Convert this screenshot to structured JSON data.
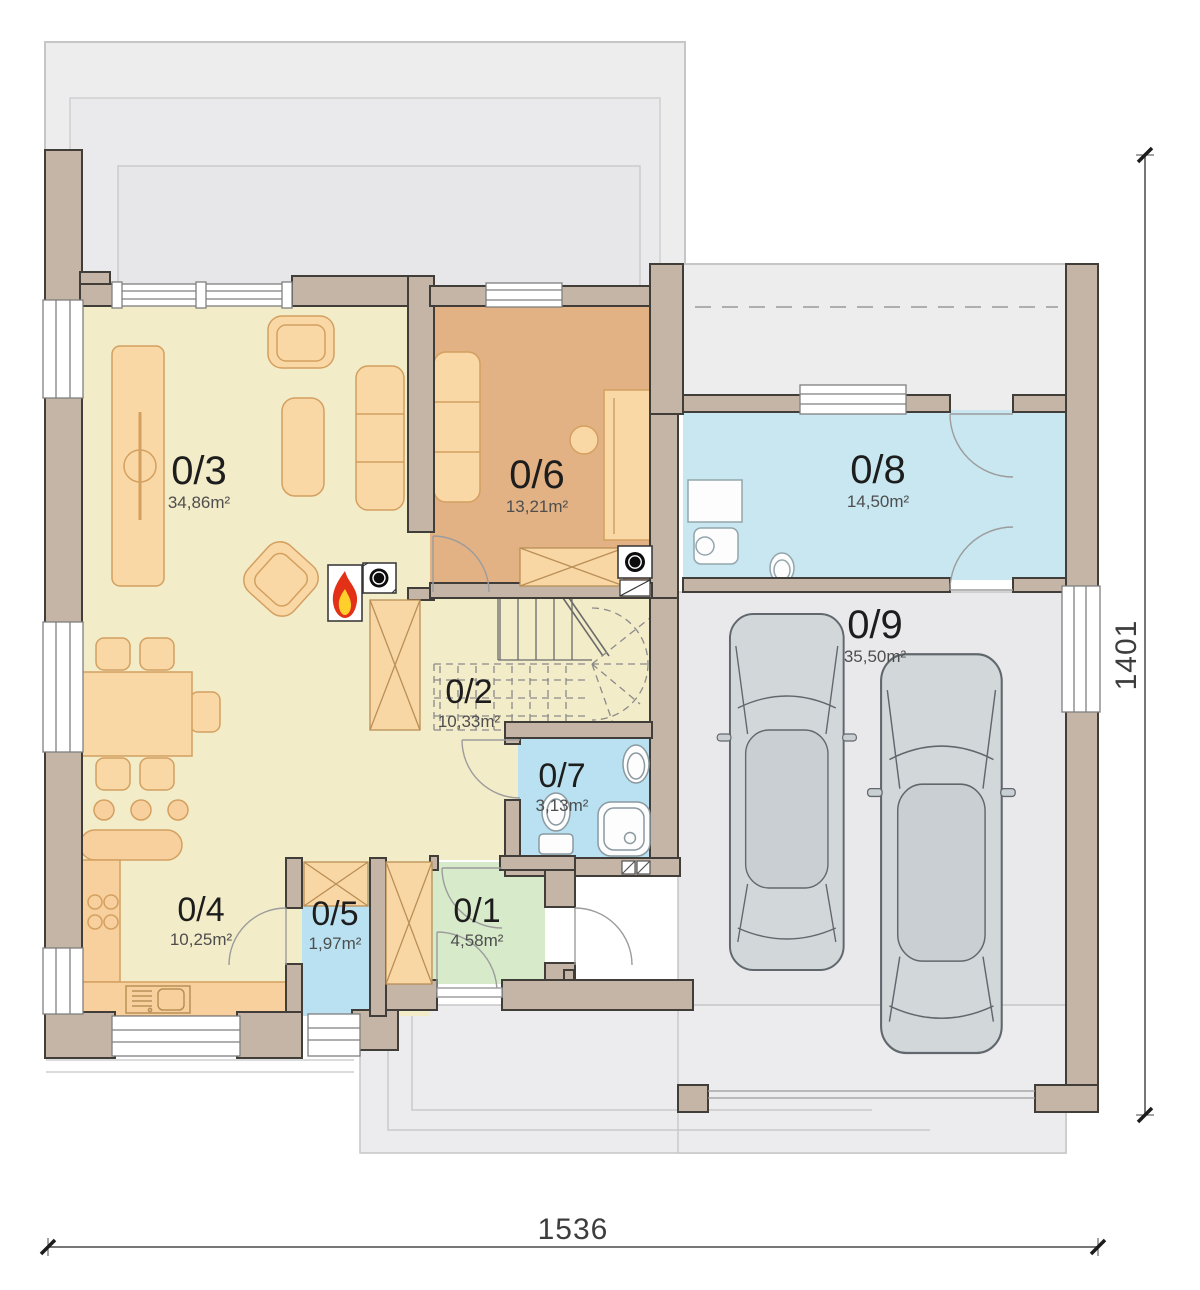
{
  "plan": {
    "rooms": [
      {
        "number": "0/1",
        "area": "4,58m²"
      },
      {
        "number": "0/2",
        "area": "10,33m²"
      },
      {
        "number": "0/3",
        "area": "34,86m²"
      },
      {
        "number": "0/4",
        "area": "10,25m²"
      },
      {
        "number": "0/5",
        "area": "1,97m²"
      },
      {
        "number": "0/6",
        "area": "13,21m²"
      },
      {
        "number": "0/7",
        "area": "3,13m²"
      },
      {
        "number": "0/8",
        "area": "14,50m²"
      },
      {
        "number": "0/9",
        "area": "35,50m²"
      }
    ],
    "dimensions": {
      "bottom": "1536",
      "right": "1401"
    },
    "colors": {
      "cream_floor": "#f3ecc8",
      "tan_floor": "#e2b184",
      "blue_floor": "#b9e1f1",
      "blue_floor_light": "#c8e7f1",
      "green_floor": "#d7eac9",
      "garage_floor": "#e9e9eb",
      "terrace_floor": "#ededee",
      "wall": "#c4b5a6",
      "furniture": "#fad8a6",
      "flame_red": "#e33117",
      "flame_yellow": "#ffd02b"
    }
  }
}
